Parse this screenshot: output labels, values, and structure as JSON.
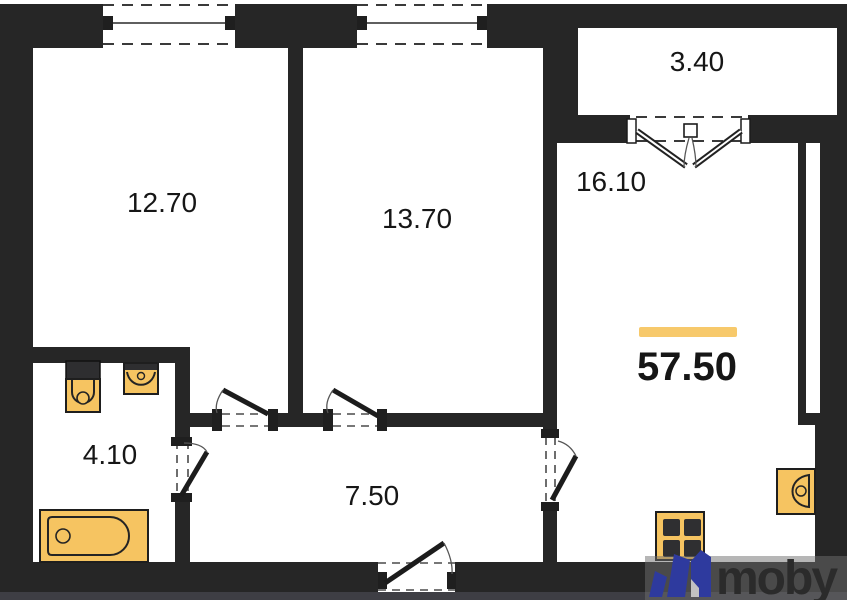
{
  "floor_plan": {
    "total_area_label": "57.50",
    "rooms": [
      {
        "name": "bedroom-1",
        "area_label": "12.70"
      },
      {
        "name": "bedroom-2",
        "area_label": "13.70"
      },
      {
        "name": "living-kitchen",
        "area_label": "16.10"
      },
      {
        "name": "balcony",
        "area_label": "3.40"
      },
      {
        "name": "bathroom",
        "area_label": "4.10"
      },
      {
        "name": "hallway",
        "area_label": "7.50"
      }
    ],
    "fixtures": [
      "toilet",
      "wash-basin",
      "bathtub",
      "kitchen-sink",
      "stove"
    ],
    "colors": {
      "wall": "#262626",
      "fixture_fill": "#F6C461",
      "fixture_outline": "#1E1E1E",
      "accent_bar": "#F7C96B",
      "label_text": "#161616"
    }
  },
  "watermark": {
    "brand_text": "moby",
    "icon": "moby-logo-icon",
    "band_color": "rgba(110,110,110,0.5)",
    "logo_blue": "#2E3A9E",
    "text_color": "#2B2B2B"
  }
}
